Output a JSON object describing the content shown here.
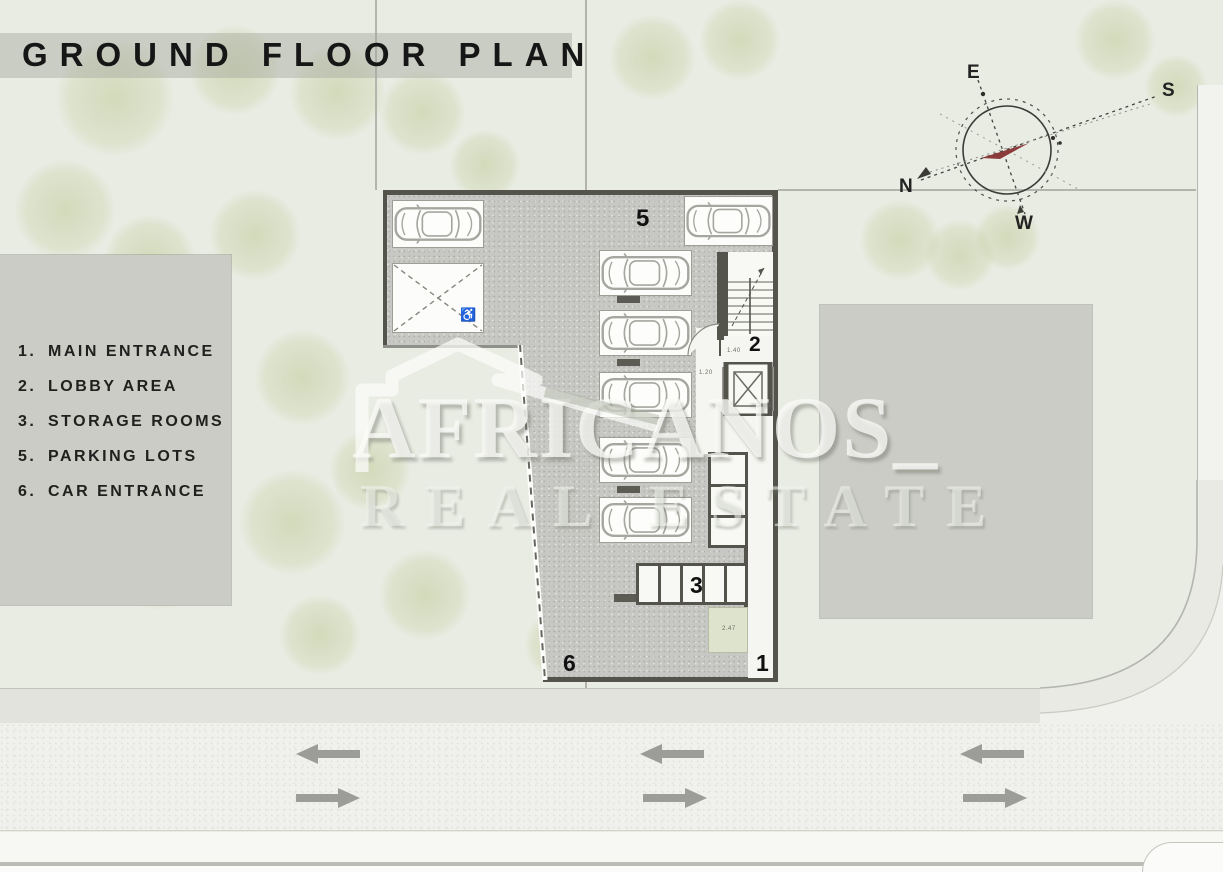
{
  "title": "GROUND FLOOR PLAN",
  "legend": {
    "items": [
      {
        "num": "1.",
        "label": "MAIN ENTRANCE"
      },
      {
        "num": "2.",
        "label": "LOBBY AREA"
      },
      {
        "num": "3.",
        "label": "STORAGE ROOMS"
      },
      {
        "num": "5.",
        "label": "PARKING LOTS"
      },
      {
        "num": "6.",
        "label": "CAR ENTRANCE"
      }
    ]
  },
  "plan": {
    "markers": {
      "main_entrance": "1",
      "lobby_area": "2",
      "storage_rooms": "3",
      "parking_lots": "5",
      "car_entrance": "6"
    },
    "dimensions": {
      "lobby_depth": "1.40",
      "door_width": "1.20",
      "planter": "2.47"
    }
  },
  "compass": {
    "east": "E",
    "south": "S",
    "north": "N",
    "west": "W"
  },
  "watermark": {
    "brand": "AFRICANOS_",
    "tagline": "REAL ESTATE"
  },
  "icons": {
    "wheelchair": "♿"
  },
  "colors": {
    "wall": "#54544d",
    "paving": "#c7c7c3",
    "landscape": "#e9ece3",
    "road": "#f0f0ed",
    "block": "#cbccc6",
    "arrow": "#9c9c99",
    "needle": "#8c3b3b"
  }
}
